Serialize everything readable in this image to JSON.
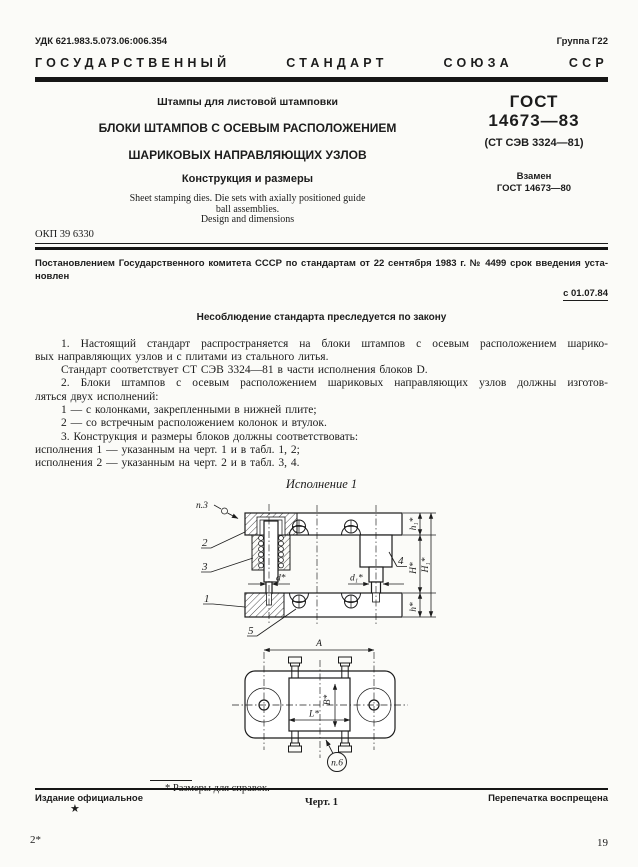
{
  "header": {
    "udk": "УДК 621.983.5.073.06:006.354",
    "group": "Группа Г22",
    "banner_words": [
      "ГОСУДАРСТВЕННЫЙ",
      "СТАНДАРТ",
      "СОЮЗА",
      "ССР"
    ]
  },
  "title_block": {
    "subject": "Штампы для листовой штамповки",
    "title_line1": "БЛОКИ ШТАМПОВ С ОСЕВЫМ РАСПОЛОЖЕНИЕМ",
    "title_line2": "ШАРИКОВЫХ НАПРАВЛЯЮЩИХ УЗЛОВ",
    "subtitle": "Конструкция и размеры",
    "english_line1": "Sheet stamping dies. Die sets with axially  positioned  guide",
    "english_line2": "ball assemblies.",
    "english_line3": "Design and dimensions"
  },
  "designation": {
    "gost": "ГОСТ",
    "number": "14673—83",
    "st_sev": "(СТ СЭВ 3324—81)",
    "replaces_label": "Взамен",
    "replaces_number": "ГОСТ 14673—80"
  },
  "okp": "ОКП 39 6330",
  "decree": {
    "line1": "Постановлением Государственного комитета СССР по стандартам от 22 сентября 1983 г. № 4499 срок введения уста-",
    "line2": "новлен",
    "effective": "с 01.07.84",
    "law": "Несоблюдение стандарта преследуется по закону"
  },
  "body": {
    "lines": [
      "1. Настоящий стандарт распространяется на блоки штампов с осевым расположением шарико-",
      "вых направляющих узлов и с плитами из стального литья.",
      "Стандарт соответствует СТ СЭВ 3324—81 в части исполнения блоков D.",
      "2. Блоки штампов с осевым расположением шариковых направляющих узлов должны изготов-",
      "ляться двух исполнений:",
      "1 — с колонками, закрепленными в нижней плите;",
      "2 — со встречным расположением колонок и втулок.",
      "3. Конструкция и размеры блоков должны соответствовать:",
      "исполнения 1 — указанным на черт. 1 и в табл. 1, 2;",
      "исполнения 2 — указанным на черт. 2 и в табл. 3, 4."
    ]
  },
  "figure": {
    "caption": "Исполнение 1",
    "labels": {
      "p3": "п.3",
      "part1": "1",
      "part2": "2",
      "part3": "3",
      "part4": "4",
      "part5": "5",
      "d": "d*",
      "d1": "d₁*",
      "h1": "h₁*",
      "H": "Н*",
      "H1": "Н₁*",
      "h": "h*",
      "A": "А",
      "B": "В*",
      "L": "L*",
      "p6": "п.6"
    },
    "footnote": "* Размеры для справок.",
    "number": "Черт. 1"
  },
  "footer": {
    "left": "Издание официальное",
    "star": "★",
    "right": "Перепечатка воспрещена",
    "page_marker": "2*",
    "page_number": "19"
  }
}
